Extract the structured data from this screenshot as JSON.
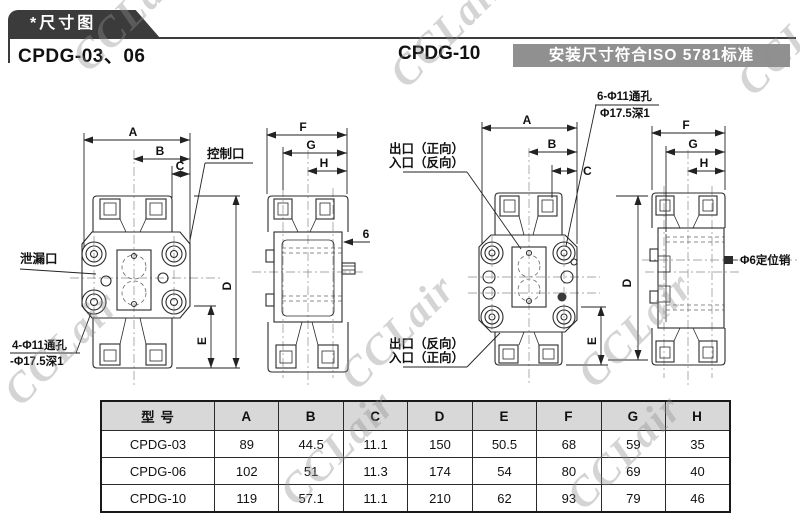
{
  "header": {
    "tab_label": "*尺寸图"
  },
  "sections": {
    "left_model": "CPDG-03、06",
    "right_model": "CPDG-10",
    "iso_note": "安装尺寸符合ISO 5781标准"
  },
  "watermark": {
    "text": "CCLair"
  },
  "v1": {
    "A": "A",
    "B": "B",
    "C": "C",
    "D": "D",
    "E": "E",
    "control": "控制口",
    "leak": "泄漏口",
    "note1": "4-Φ11通孔",
    "note2": "-Φ17.5深1"
  },
  "v2": {
    "F": "F",
    "G": "G",
    "H": "H",
    "six": "6"
  },
  "v3": {
    "A": "A",
    "B": "B",
    "C": "C",
    "E": "E",
    "top1": "出口（正向）",
    "top2": "入口（反向）",
    "bot1": "出口（反向）",
    "bot2": "入口（正向）",
    "note1": "6-Φ11通孔",
    "note2": "Φ17.5深1"
  },
  "v4": {
    "D": "D",
    "F": "F",
    "G": "G",
    "H": "H",
    "pin": "Φ6定位销"
  },
  "table": {
    "headers": [
      "型 号",
      "A",
      "B",
      "C",
      "D",
      "E",
      "F",
      "G",
      "H"
    ],
    "rows": [
      [
        "CPDG-03",
        "89",
        "44.5",
        "11.1",
        "150",
        "50.5",
        "68",
        "59",
        "35"
      ],
      [
        "CPDG-06",
        "102",
        "51",
        "11.3",
        "174",
        "54",
        "80",
        "69",
        "40"
      ],
      [
        "CPDG-10",
        "119",
        "57.1",
        "11.1",
        "210",
        "62",
        "93",
        "79",
        "46"
      ]
    ]
  }
}
